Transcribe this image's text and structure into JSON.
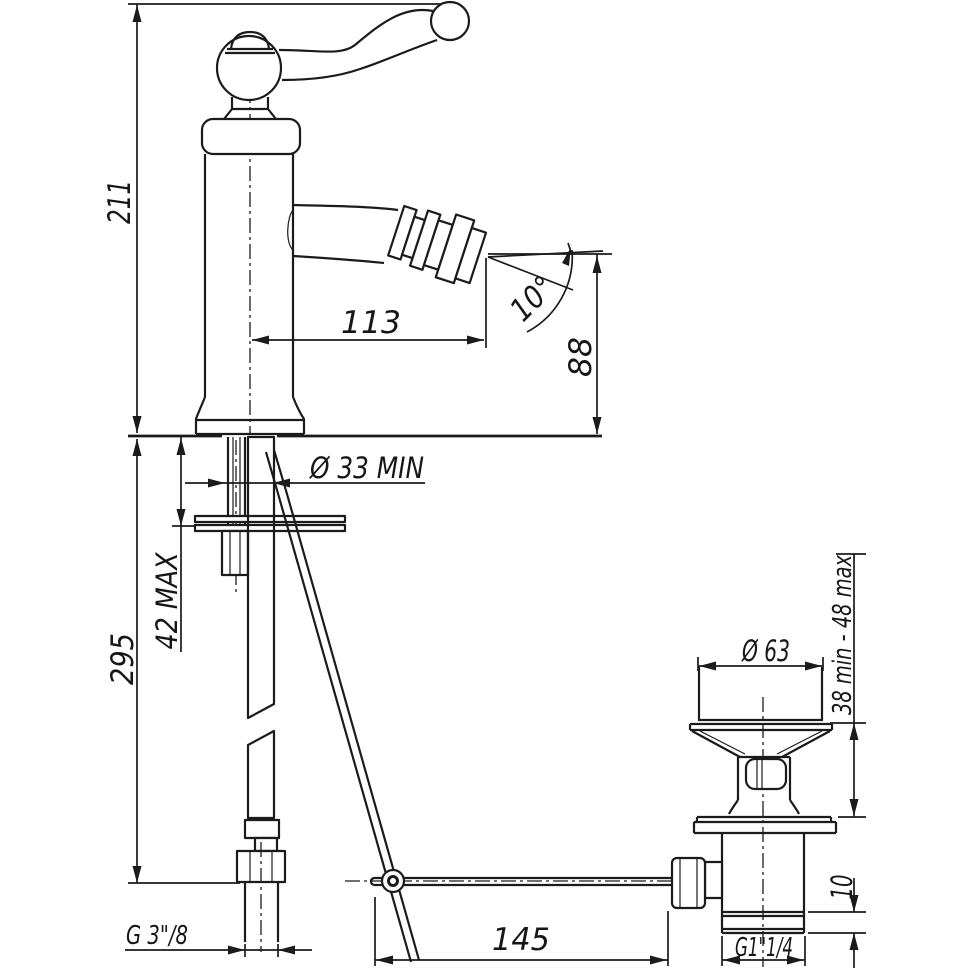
{
  "drawing": {
    "description": "Technical dimension drawing of a single-lever bidet mixer tap with flexible supply hose, pop-up rod linkage and pop-up waste drain",
    "background_color": "#ffffff",
    "line_color": "#1b1b1b",
    "labels": {
      "height_total": "211",
      "hose_length": "295",
      "deck_max": "42 MAX",
      "hole_min": "Ø 33  MIN",
      "spout_reach": "113",
      "spout_angle": "10°",
      "spout_height": "88",
      "flange_dia": "Ø 63",
      "clamp_range": "38 min  -  48 max",
      "collar_height": "10",
      "waste_thread": "G1\"1/4",
      "rod_reach": "145",
      "supply_thread": "G 3\"/8"
    }
  }
}
